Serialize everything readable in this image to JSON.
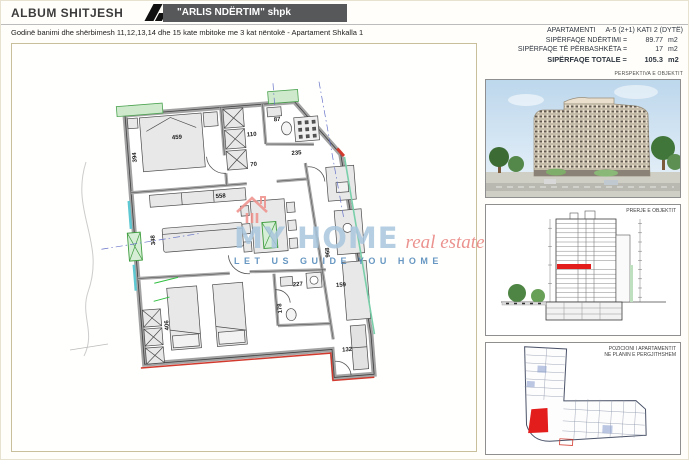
{
  "header": {
    "title": "ALBUM SHITJESH",
    "company": "\"ARLIS NDËRTIM\" shpk",
    "subtitle": "Godinë banimi dhe shërbimesh 11,12,13,14 dhe 15 kate mbitoke me 3 kat nëntokë - Apartament Shkalla 1"
  },
  "info": {
    "apartment_label": "APARTAMENTI",
    "apartment_value": "A-5  (2+1)  KATI 2 (DYTË)",
    "rows": [
      {
        "label": "SIPËRFAQE NDËRTIMI =",
        "value": "89.77",
        "unit": "m2"
      },
      {
        "label": "SIPËRFAQE TË PËRBASHKËTA =",
        "value": "17",
        "unit": "m2"
      },
      {
        "label": "SIPËRFAQE TOTALE =",
        "value": "105.3",
        "unit": "m2"
      }
    ]
  },
  "panels": {
    "perspective_label": "PERSPEKTIVA E OBJEKTIT",
    "section_label": "PRERJE E OBJEKTIT",
    "position_label_line1": "POZICIONI I APARTAMENTIT",
    "position_label_line2": "NE PLANIN E PERGJITHSHEM"
  },
  "watermark": {
    "brand": "MY HOME",
    "brand_suffix": "real estate",
    "registered": "®",
    "slogan": "LET US GUIDE YOU HOME"
  },
  "plan": {
    "dims": {
      "bed1": "459",
      "bedroom1_depth": "394",
      "closet": "110",
      "hall": "70",
      "bath1": "87",
      "shaft": "235",
      "living_width": "558",
      "living_depth": "348",
      "bath2": "227",
      "bath2_depth": "178",
      "kitchen": "159",
      "kitchen_depth": "968",
      "balcony": "132",
      "bedroom2_depth": "406"
    }
  },
  "colors": {
    "accent_red": "#d23a2e",
    "banner_gray": "#57585a",
    "watermark_blue": "#a9c6de",
    "slogan_blue": "#4d86b8",
    "estate_red": "#e8807c",
    "window_green": "#4aa34f",
    "window_teal": "#5ec8d2",
    "highlight_red": "#e31c1c"
  }
}
